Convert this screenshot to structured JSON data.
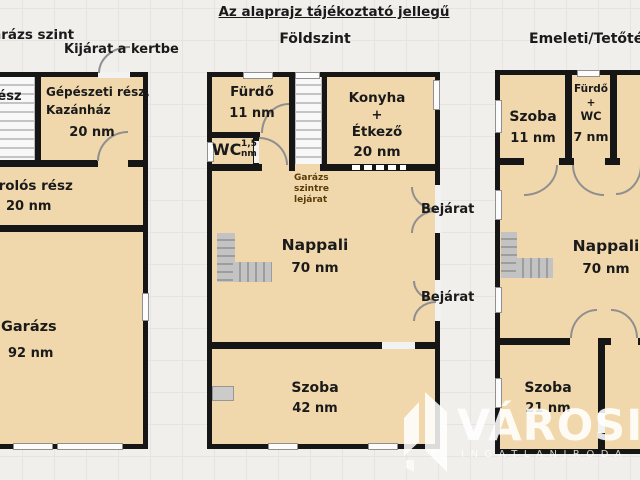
{
  "title": "Az alaprajz tájékoztató jellegű",
  "headers": {
    "left": "Garázs szint",
    "left_exit": "Kijárat a kertbe",
    "middle": "Földszint",
    "right": "Emeleti/Tetőtér"
  },
  "left_plan": {
    "floor_name": "Garázs szint",
    "stair_room": "rész",
    "mechanical": {
      "lines": [
        "Gépészeti rész,",
        "Kazánház"
      ],
      "area": "20 nm"
    },
    "storage": {
      "label": "Tárolós rész",
      "area": "20 nm"
    },
    "garage": {
      "label": "Garázs",
      "area": "92 nm"
    }
  },
  "middle_plan": {
    "floor_name": "Földszint",
    "bath": {
      "label": "Fürdő",
      "area": "11 nm"
    },
    "wc": {
      "label": "WC",
      "area_top": "1,5",
      "area_bottom": "nm"
    },
    "kitchen": {
      "lines": [
        "Konyha",
        "+",
        "Étkező"
      ],
      "area": "20 nm"
    },
    "stairs_note": {
      "lines": [
        "Garázs",
        "szintre",
        "lejárat"
      ]
    },
    "living": {
      "label": "Nappali",
      "area": "70 nm"
    },
    "entrance_top": "Bejárat",
    "entrance_bottom": "Bejárat",
    "room": {
      "label": "Szoba",
      "area": "42 nm"
    }
  },
  "right_plan": {
    "floor_name": "Emeleti/Tetőtér",
    "room_top": {
      "label": "Szoba",
      "area": "11 nm"
    },
    "bath_wc": {
      "lines": [
        "Fürdő",
        "+",
        "WC"
      ],
      "area": "7 nm"
    },
    "living": {
      "label": "Nappali",
      "area": "70 nm"
    },
    "room_bottom": {
      "label": "Szoba",
      "area": "21 nm"
    }
  },
  "watermark": {
    "brand": "VÁROSI",
    "subtitle": "INGATLANIRODA"
  },
  "colors": {
    "room_fill": "#f1d8ac",
    "wall": "#161616",
    "background": "#f1efec",
    "grid_line": "#e6e3e0",
    "watermark_text": "#ffffff",
    "stairs_note_text": "#5a3c08"
  }
}
